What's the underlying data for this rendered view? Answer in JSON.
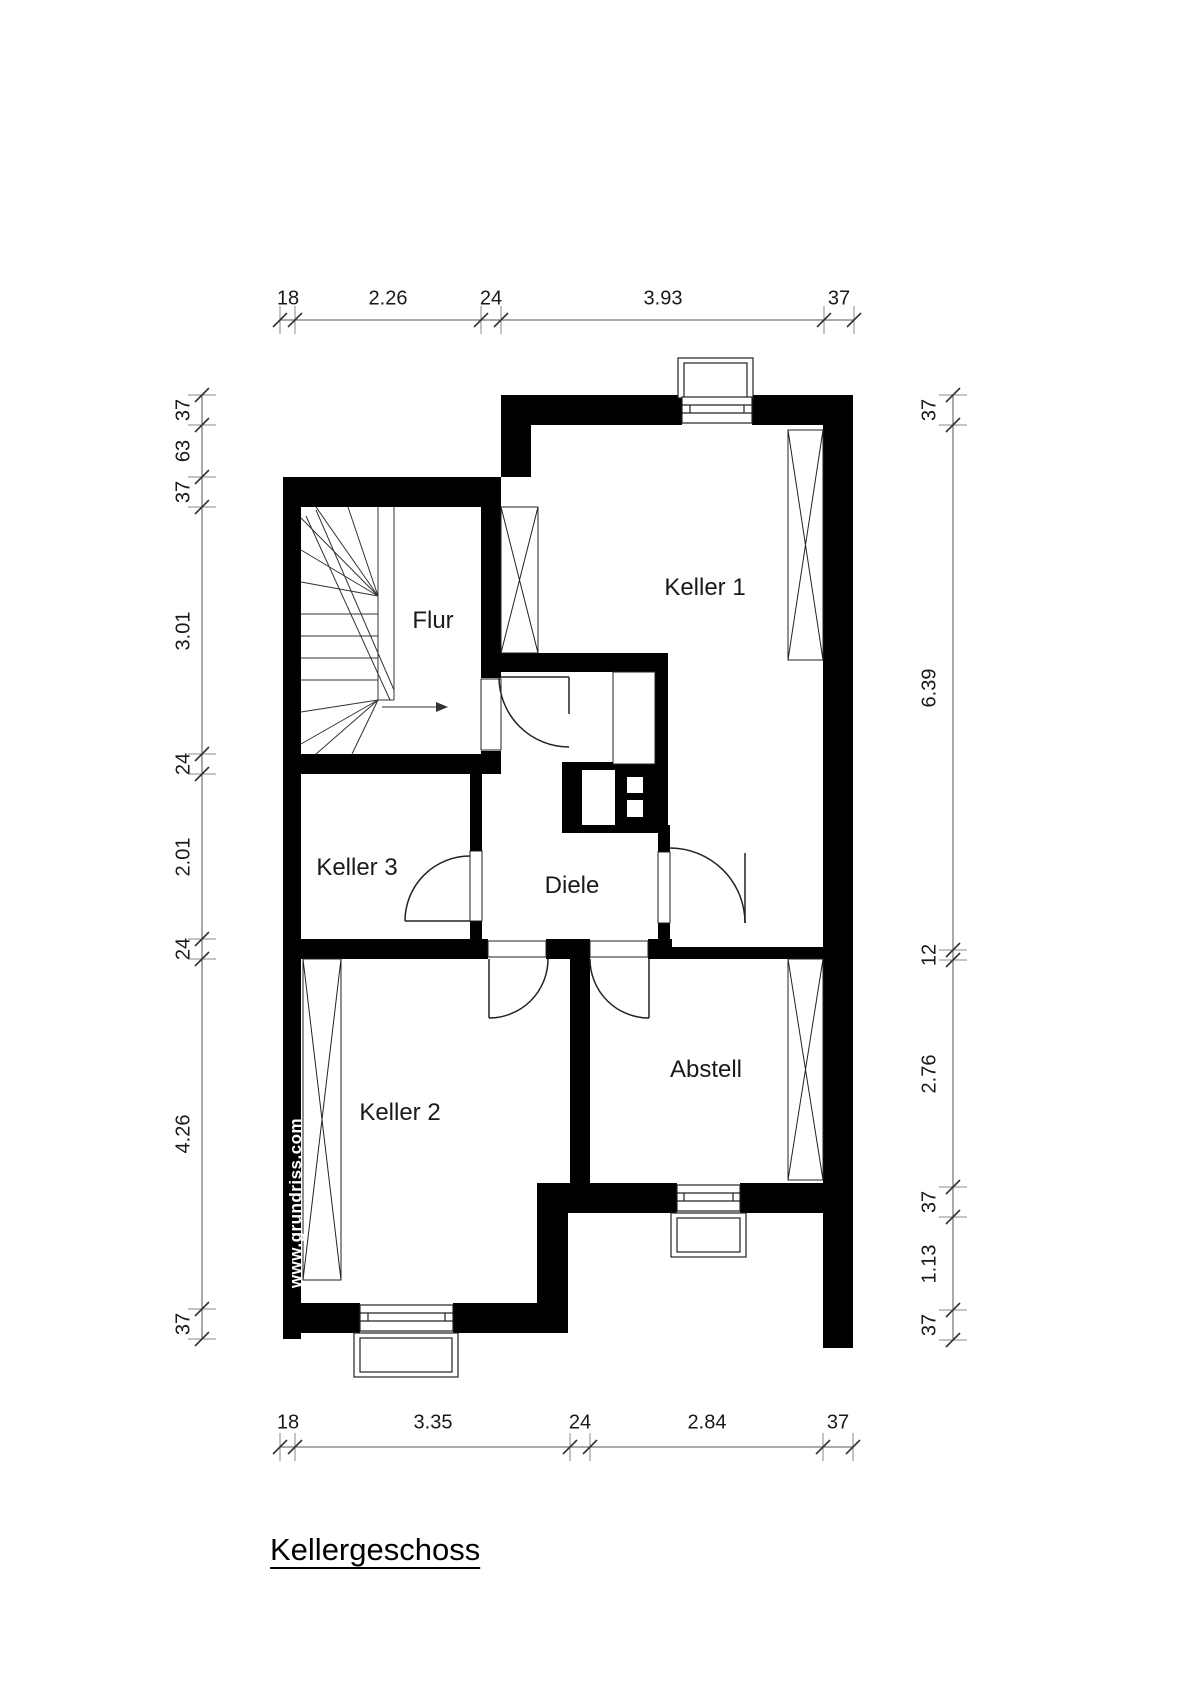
{
  "title": "Kellergeschoss",
  "watermark": "www.grundriss.com",
  "rooms": [
    {
      "id": "flur",
      "label": "Flur"
    },
    {
      "id": "keller-1",
      "label": "Keller 1"
    },
    {
      "id": "keller-3",
      "label": "Keller 3"
    },
    {
      "id": "diele",
      "label": "Diele"
    },
    {
      "id": "keller-2",
      "label": "Keller 2"
    },
    {
      "id": "abstell",
      "label": "Abstell"
    }
  ],
  "dimensions": {
    "top": [
      "18",
      "2.26",
      "24",
      "3.93",
      "37"
    ],
    "bottom": [
      "18",
      "3.35",
      "24",
      "2.84",
      "37"
    ],
    "left": [
      "37",
      "63",
      "37",
      "3.01",
      "24",
      "2.01",
      "24",
      "4.26",
      "37"
    ],
    "right": [
      "37",
      "6.39",
      "12",
      "2.76",
      "37",
      "1.13",
      "37"
    ]
  }
}
